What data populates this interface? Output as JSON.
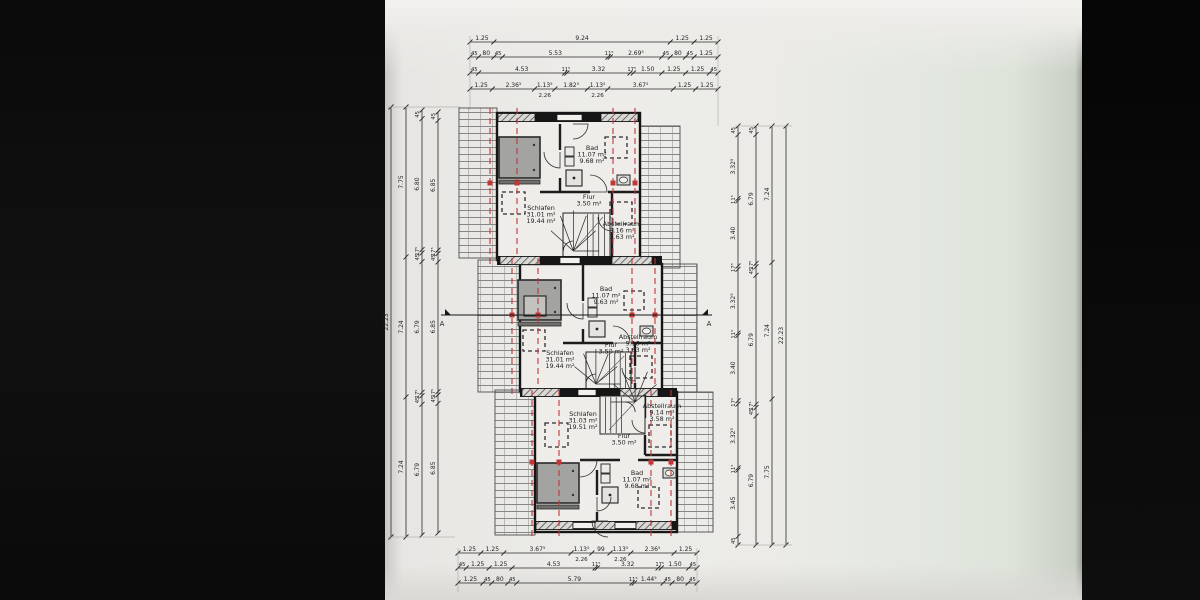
{
  "drawing": {
    "type": "floor-plan",
    "language": "de",
    "section": {
      "marker": "A"
    },
    "units": [
      {
        "id": "unit-top",
        "rooms": [
          {
            "name": "Schlafen",
            "areas": [
              "31.01 m²",
              "19.44 m²"
            ]
          },
          {
            "name": "Bad",
            "areas": [
              "11.07 m²",
              "9.68 m²"
            ]
          },
          {
            "name": "Flur",
            "areas": [
              "3.50 m²"
            ]
          },
          {
            "name": "Abstellraum",
            "areas": [
              "9.16 m²",
              "3.63 m²"
            ]
          }
        ]
      },
      {
        "id": "unit-middle",
        "rooms": [
          {
            "name": "Schlafen",
            "areas": [
              "31.01 m²",
              "19.44 m²"
            ]
          },
          {
            "name": "Bad",
            "areas": [
              "11.07 m²",
              "9.63 m²"
            ]
          },
          {
            "name": "Flur",
            "areas": [
              "3.50 m²"
            ]
          },
          {
            "name": "Abstellraum",
            "areas": [
              "9.16 m²",
              "3.63 m²"
            ]
          }
        ]
      },
      {
        "id": "unit-bottom",
        "rooms": [
          {
            "name": "Schlafen",
            "areas": [
              "31.03 m²",
              "19.51 m²"
            ]
          },
          {
            "name": "Bad",
            "areas": [
              "11.07 m²",
              "9.68 m²"
            ]
          },
          {
            "name": "Flur",
            "areas": [
              "3.50 m²"
            ]
          },
          {
            "name": "Abstellraum",
            "areas": [
              "9.14 m²",
              "3.58 m²"
            ]
          }
        ]
      }
    ],
    "dimensions": {
      "top": [
        [
          "1.25",
          "9.24",
          "1.25",
          "1.25"
        ],
        [
          "45",
          "80",
          "45",
          "5.53",
          "11⁵",
          "2.69⁵",
          "45",
          "80",
          "45",
          "1.25"
        ],
        [
          "45",
          "4.53",
          "11⁵",
          "3.32",
          "17⁵",
          "1.50",
          "1.25",
          "1.25",
          "45"
        ],
        [
          "1.25",
          "2.36⁵",
          "1.13⁵",
          "1.82⁵",
          "1.13⁵",
          "3.67⁵",
          "1.25",
          "1.25"
        ]
      ],
      "top_sub": [
        "2.26",
        "2.26"
      ],
      "bottom": [
        [
          "1.25",
          "1.25",
          "3.67⁵",
          "1.13⁵",
          "99",
          "1.13⁵",
          "2.36⁵",
          "1.25"
        ],
        [
          "45",
          "1.25",
          "1.25",
          "4.53",
          "11⁵",
          "3.32",
          "17⁵",
          "1.50",
          "45"
        ],
        [
          "1.25",
          "45",
          "80",
          "45",
          "5.79",
          "11⁵",
          "1.44⁵",
          "45",
          "80",
          "45"
        ]
      ],
      "bottom_sub": [
        "2.26",
        "2.26"
      ],
      "left": [
        [
          "22.23"
        ],
        [
          "7.75",
          "7.24",
          "7.24"
        ],
        [
          "45",
          "6.80",
          "17⁵",
          "45",
          "6.79",
          "17⁵",
          "45",
          "6.79"
        ],
        [
          "45",
          "6.85",
          "17⁵",
          "45",
          "6.85",
          "17⁵",
          "45",
          "6.85"
        ]
      ],
      "right": [
        [
          "45",
          "3.32⁵",
          "11⁵",
          "3.40",
          "17⁵",
          "3.32⁵",
          "11⁵",
          "3.40",
          "17⁵",
          "3.32⁵",
          "11⁵",
          "3.45",
          "45"
        ],
        [
          "45",
          "6.79",
          "17⁵",
          "45",
          "6.79",
          "17⁵",
          "45",
          "6.79"
        ],
        [
          "7.24",
          "7.24",
          "7.75"
        ],
        [
          "22.23"
        ]
      ]
    },
    "colors": {
      "ink": "#1c1c1c",
      "dim": "#2a2a2a",
      "section_red": "#c23636",
      "paper": "#ecebe7",
      "room_fill": "#edecdfa"
    }
  }
}
